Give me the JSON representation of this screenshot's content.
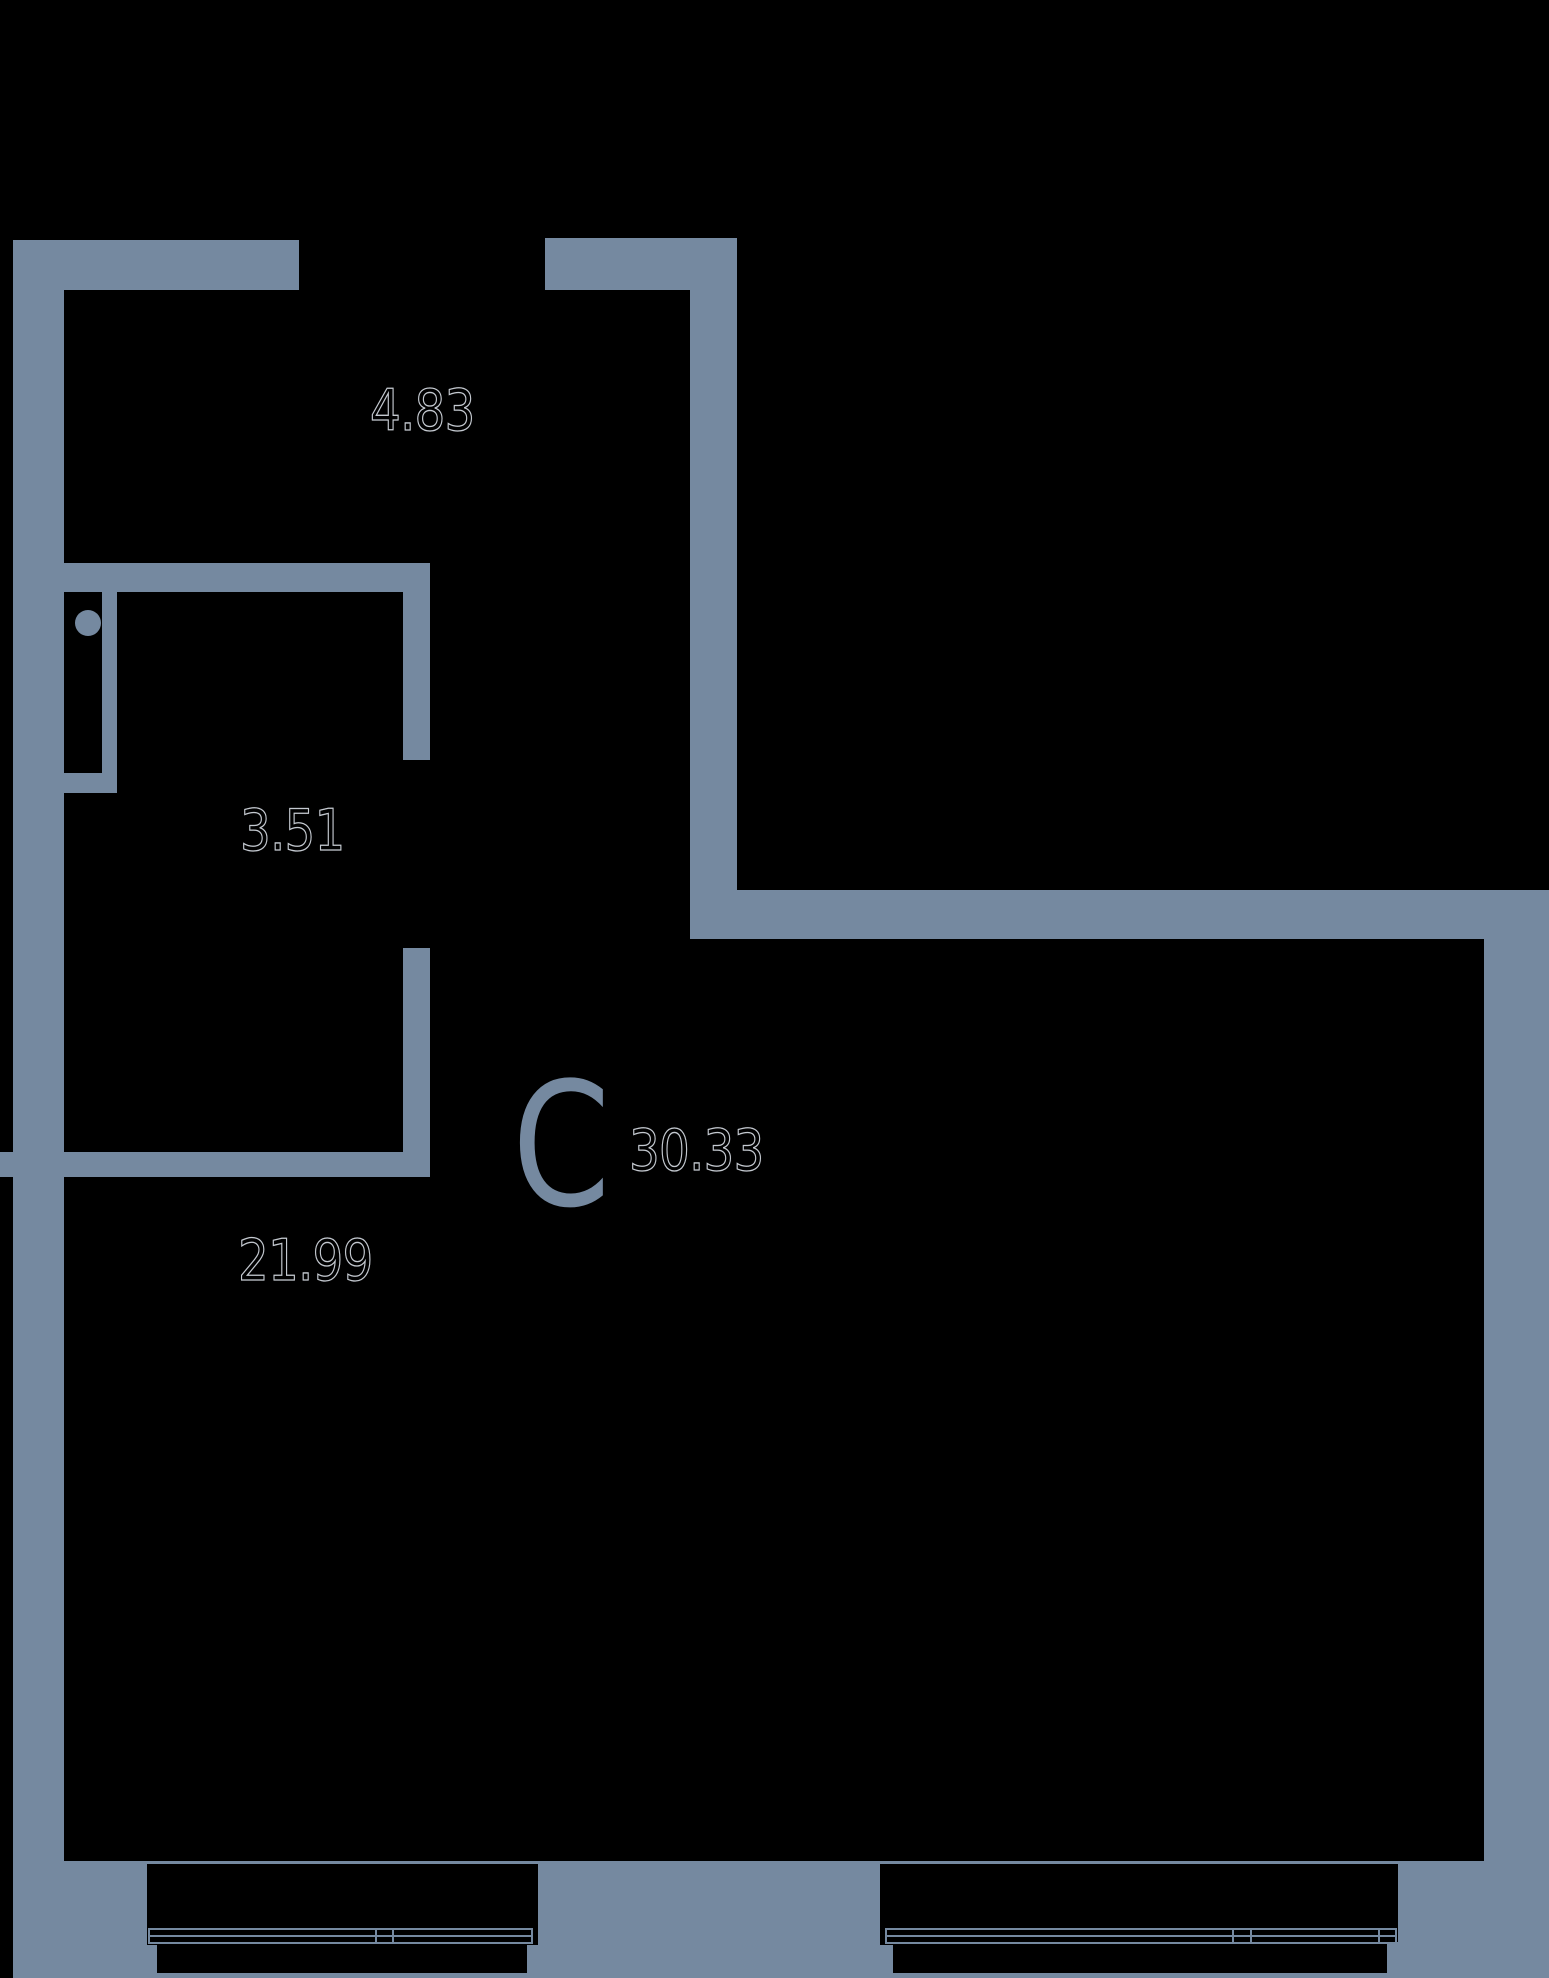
{
  "plan": {
    "title": "studio-floor-plan",
    "unit_label": "С",
    "total_area": "30.33",
    "rooms": [
      {
        "id": "upper-room",
        "area": "4.83"
      },
      {
        "id": "bathroom",
        "area": "3.51"
      },
      {
        "id": "living-room",
        "area": "21.99"
      }
    ],
    "colors": {
      "wall": "#7589A0",
      "background": "#000000",
      "label_outline": "#C4C9D0"
    }
  }
}
